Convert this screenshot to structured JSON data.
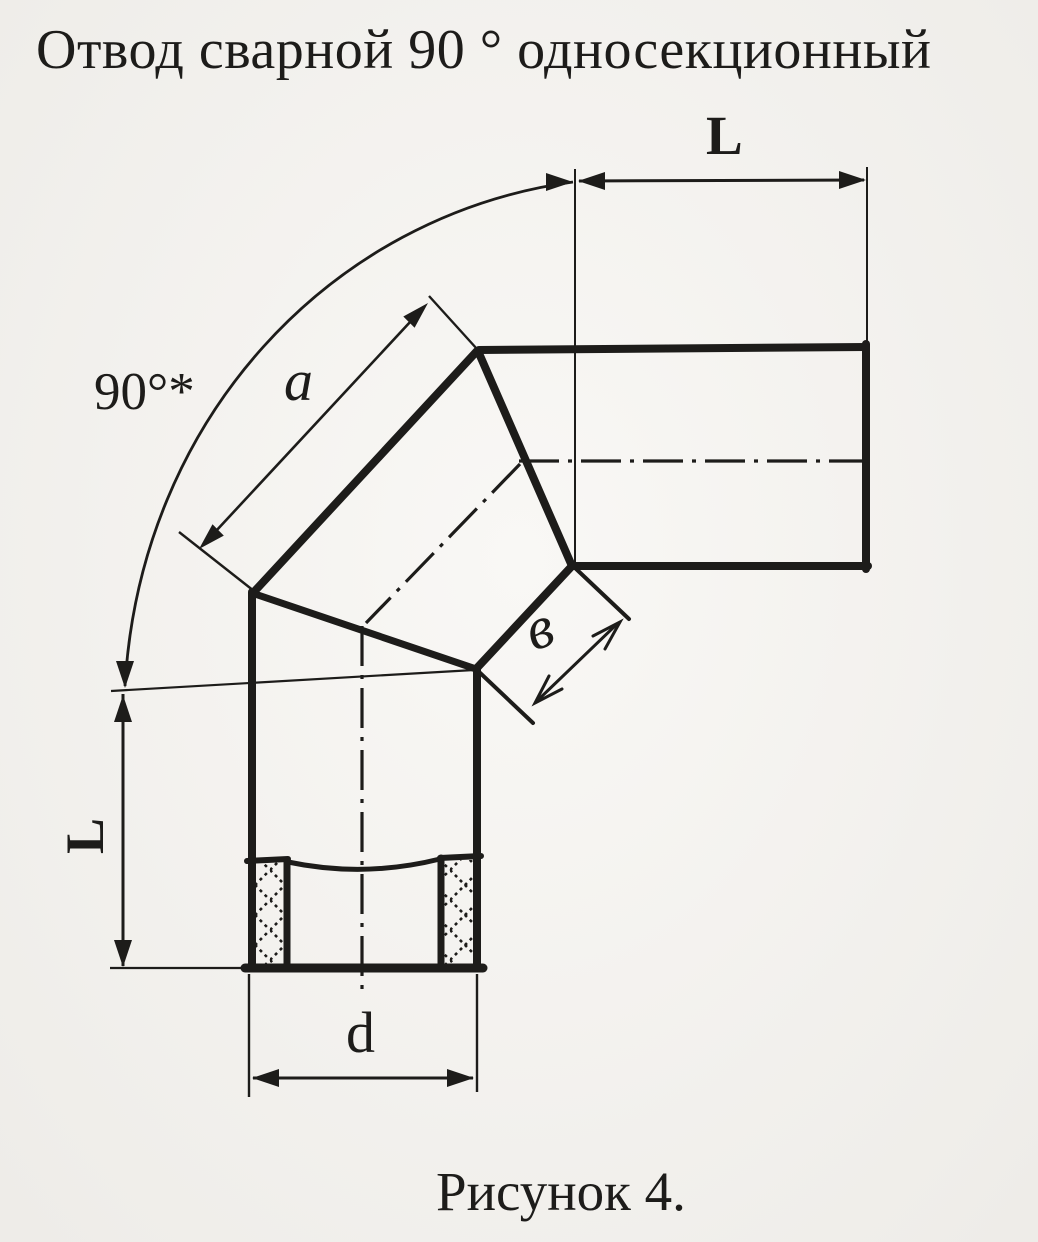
{
  "title": "Отвод сварной 90 ° односекционный",
  "caption": "Рисунок 4.",
  "dimensions": {
    "top_length": "L",
    "left_length": "L",
    "angle": "90°*",
    "section_outer_side": "a",
    "section_inner_side": "в",
    "diameter": "d"
  },
  "colors": {
    "ink": "#1d1c1a",
    "paper": "#f6f4f0"
  }
}
